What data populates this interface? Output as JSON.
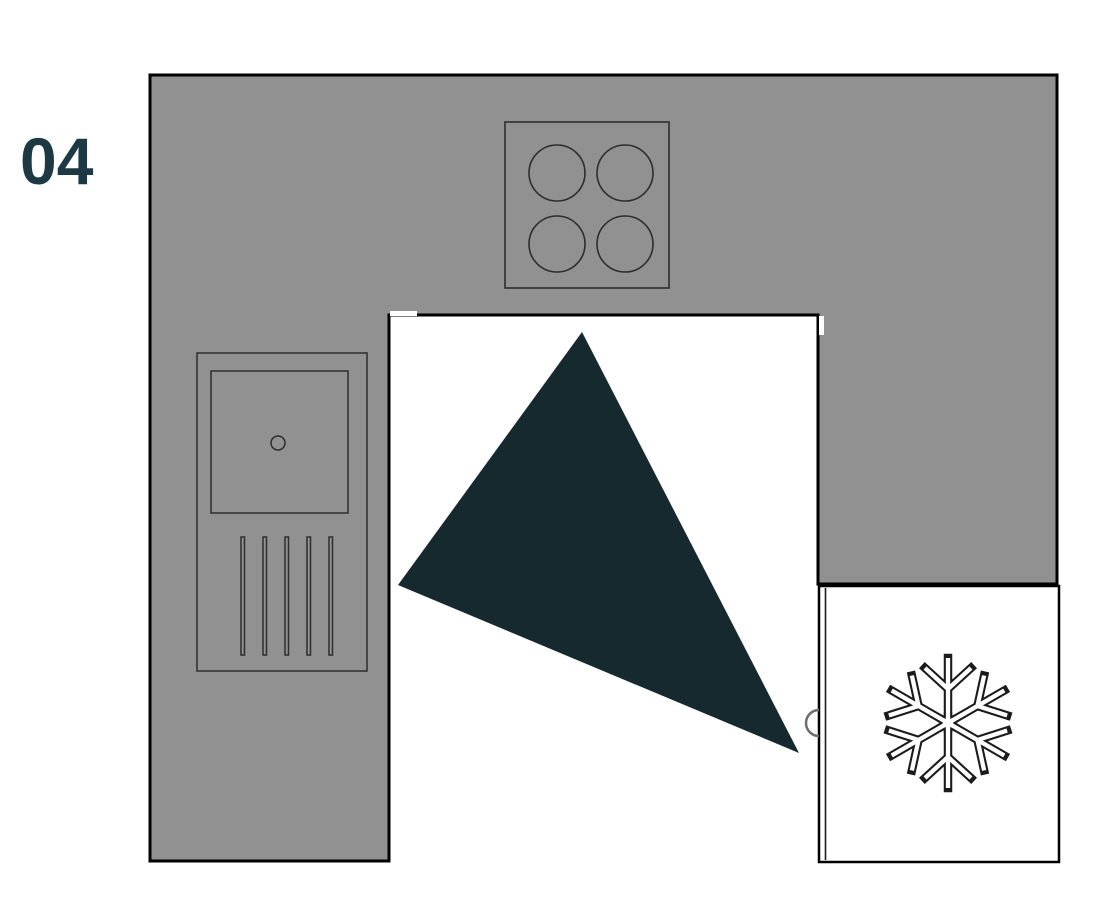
{
  "page": {
    "step_number": "04"
  },
  "colors": {
    "background": "#ffffff",
    "countertop_fill": "#919191",
    "outline": "#000000",
    "appliance_stroke": "#2e2e2e",
    "triangle_fill": "#15292f",
    "step_number_color": "#1d3a44",
    "fridge_fill": "#ffffff",
    "snowflake_stroke": "#1b1b1b",
    "handle_stroke": "#6e6e6e",
    "door_marker_white": "#ffffff"
  },
  "icons": {
    "snowflake": {
      "name": "snowflake-icon",
      "glyph": "❄",
      "meaning": "freezer / refrigerator symbol"
    },
    "burners": {
      "name": "burner-circles",
      "meaning": "four cooktop burner rings"
    },
    "oven": {
      "name": "oven-front",
      "meaning": "oven door with knob and vent slats"
    }
  }
}
